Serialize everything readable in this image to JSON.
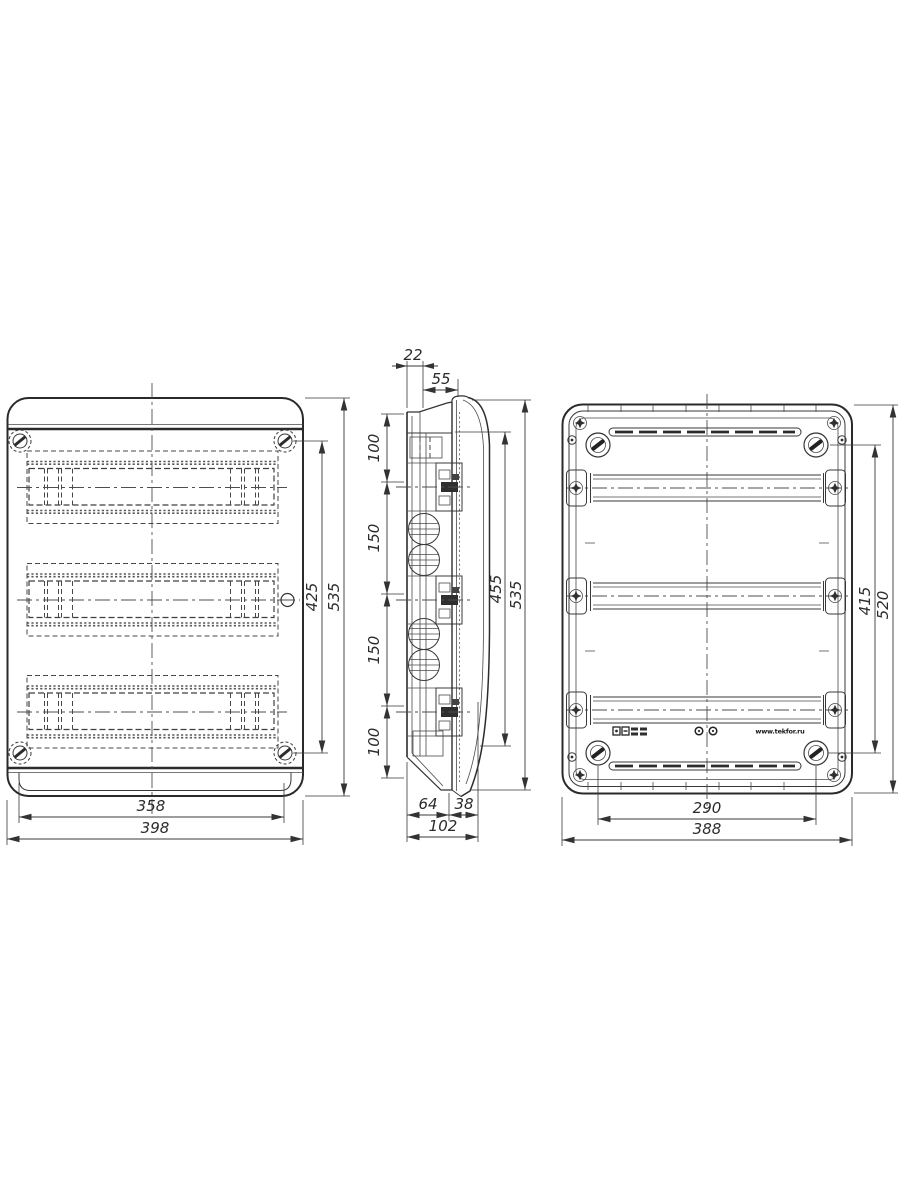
{
  "drawing": {
    "front": {
      "door_width": "358",
      "overall_width": "398",
      "hinge_span_height": "425",
      "overall_height": "535"
    },
    "side": {
      "rail_offset": "22",
      "door_offset": "55",
      "pitch_top": "100",
      "pitch_mid1": "150",
      "pitch_mid2": "150",
      "pitch_bottom": "100",
      "door_height": "455",
      "overall_height": "535",
      "base_depth": "64",
      "door_depth": "38",
      "overall_depth": "102"
    },
    "rear": {
      "mount_span_width": "290",
      "overall_width": "388",
      "mount_span_height": "415",
      "overall_height": "520",
      "marking_website": "www.tekfor.ru"
    }
  }
}
